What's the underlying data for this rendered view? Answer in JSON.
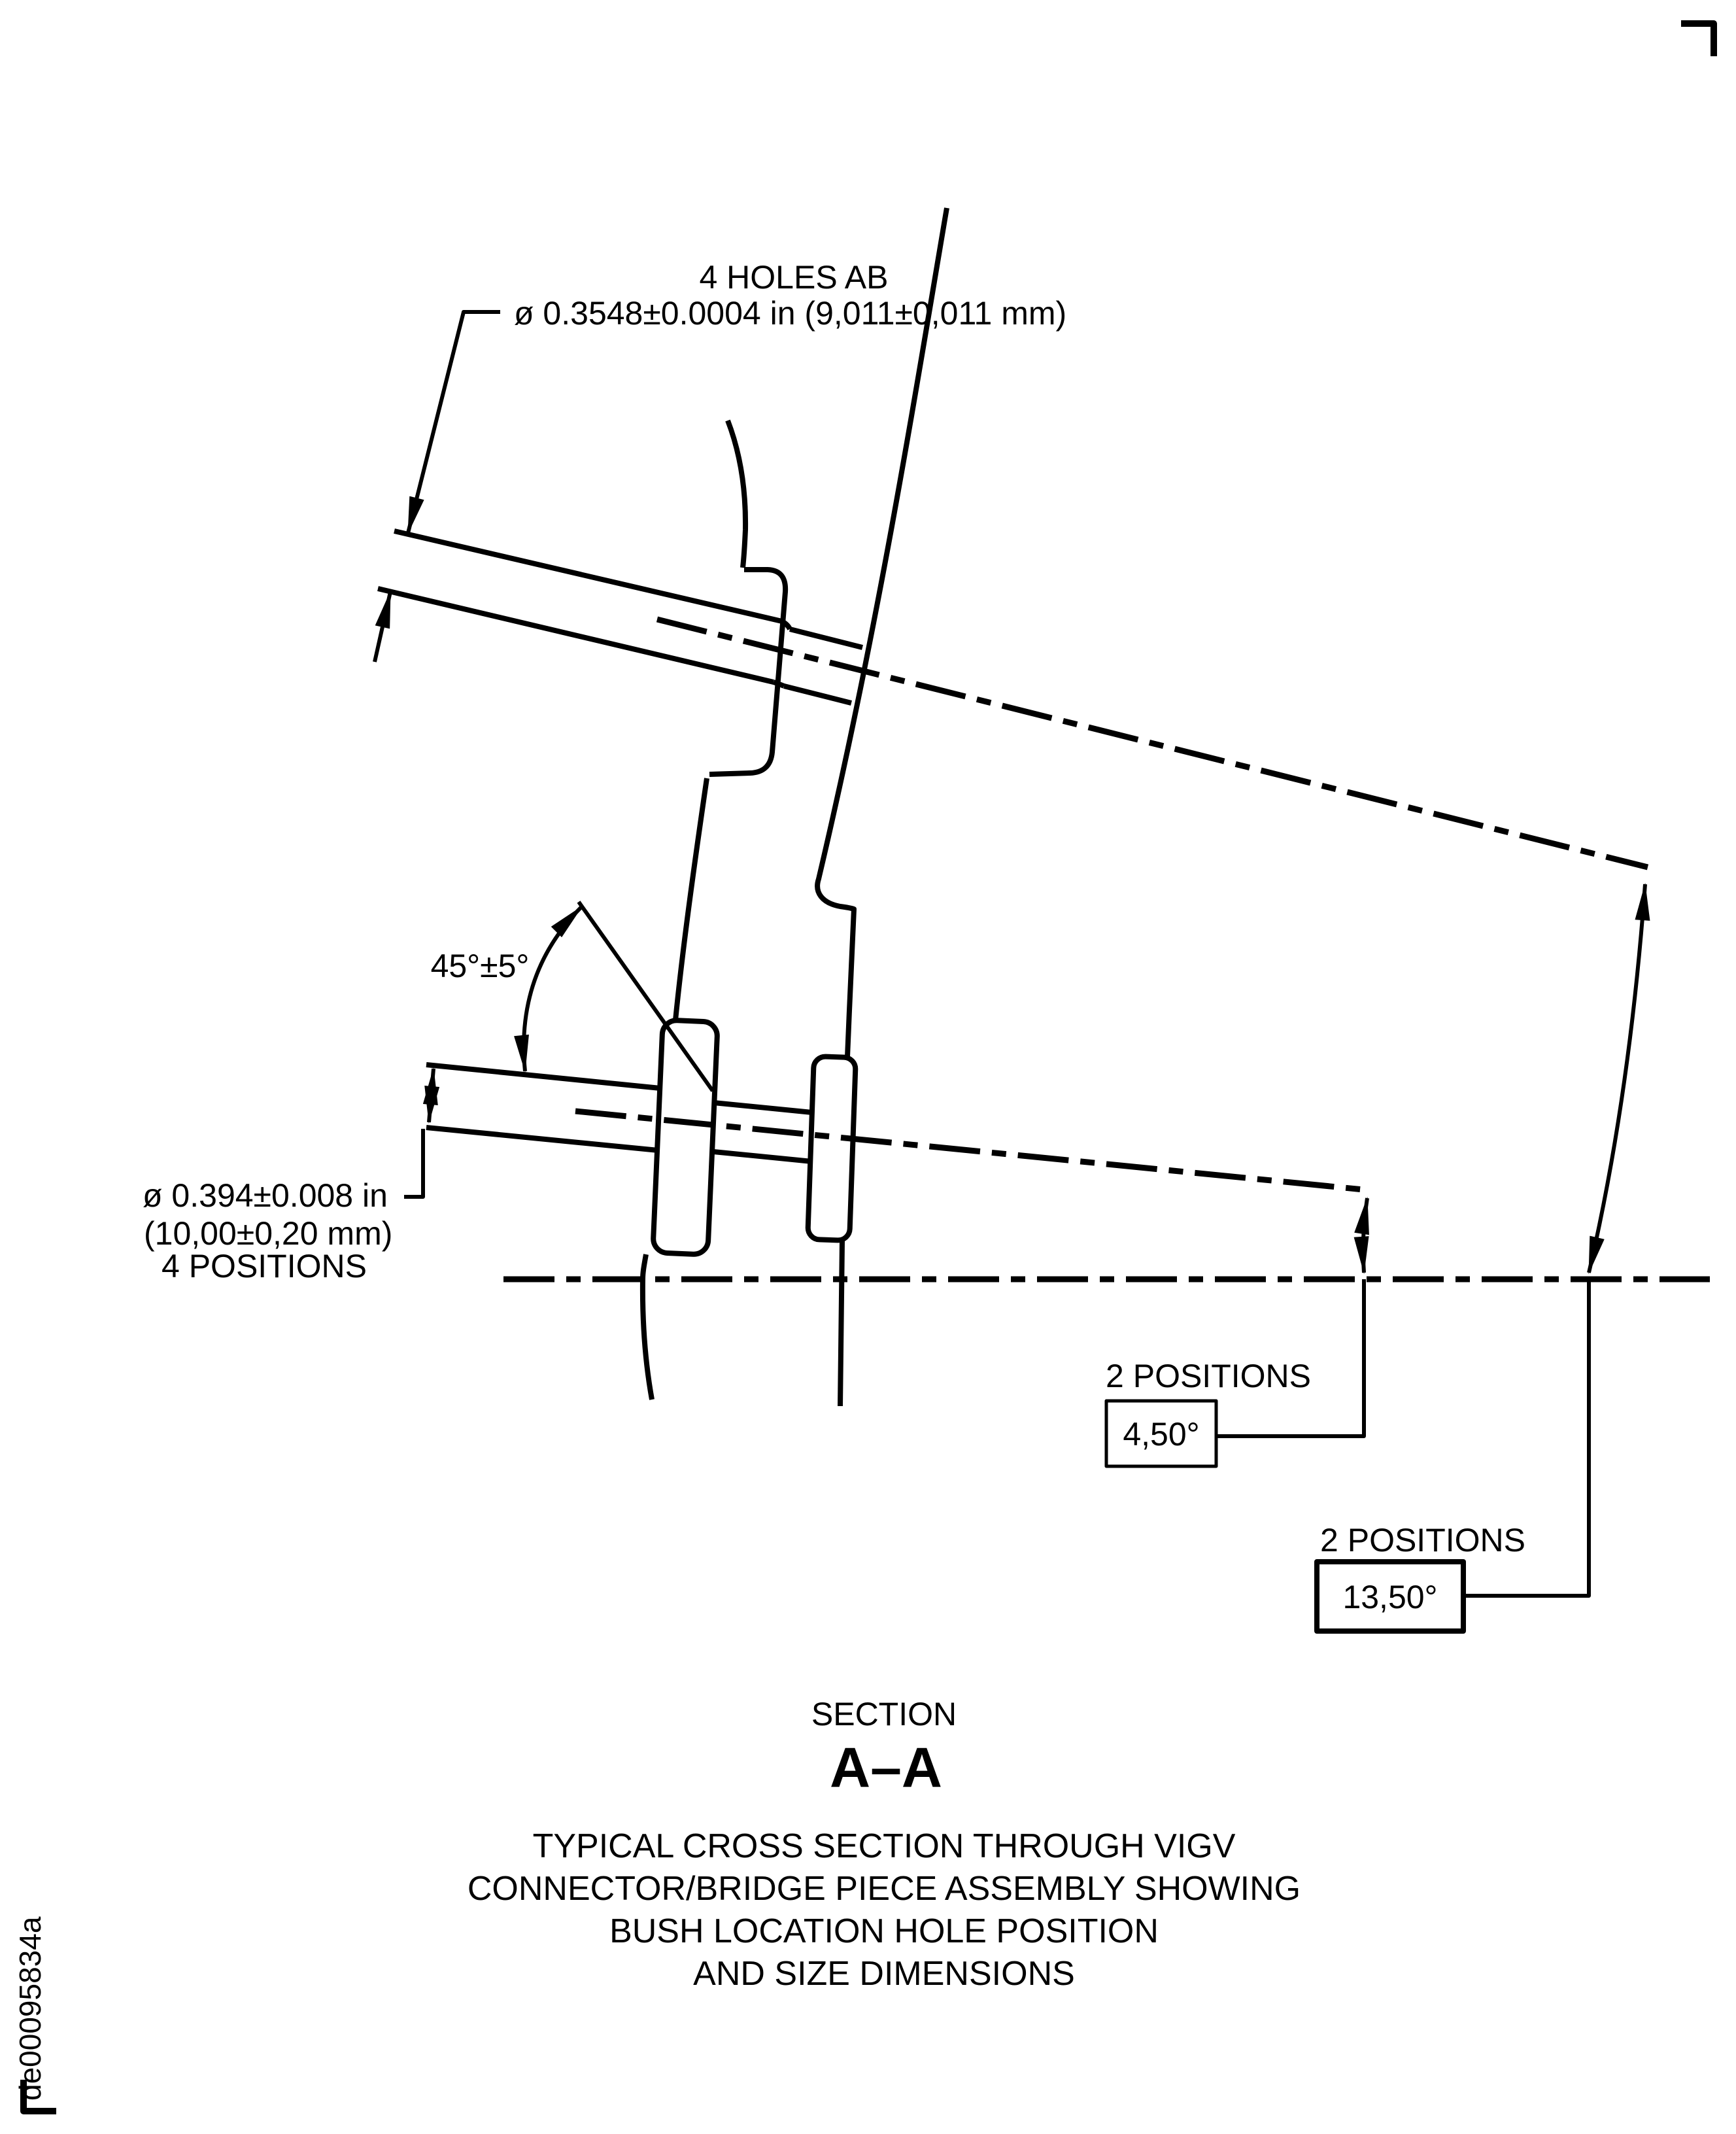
{
  "drawing": {
    "colors": {
      "ink": "#000000",
      "background": "#ffffff"
    },
    "top_label": {
      "line1": "4 HOLES AB",
      "line2": "ø 0.3548±0.0004 in (9,011±0,011 mm)"
    },
    "angle_label": "45°±5°",
    "left_label": {
      "line1": "ø 0.394±0.008 in",
      "line2": "(10,00±0,20 mm)",
      "line3": "4 POSITIONS"
    },
    "dim_4_50": {
      "caption": "2 POSITIONS",
      "value": "4,50°"
    },
    "dim_13_50": {
      "caption": "2 POSITIONS",
      "value": "13,50°"
    },
    "section": {
      "kicker": "SECTION",
      "name": "A–A"
    },
    "caption": {
      "line1": "TYPICAL CROSS SECTION THROUGH VIGV",
      "line2": "CONNECTOR/BRIDGE PIECE ASSEMBLY SHOWING",
      "line3": "BUSH LOCATION HOLE POSITION",
      "line4": "AND SIZE DIMENSIONS"
    },
    "doc_number": "de00095834a"
  }
}
